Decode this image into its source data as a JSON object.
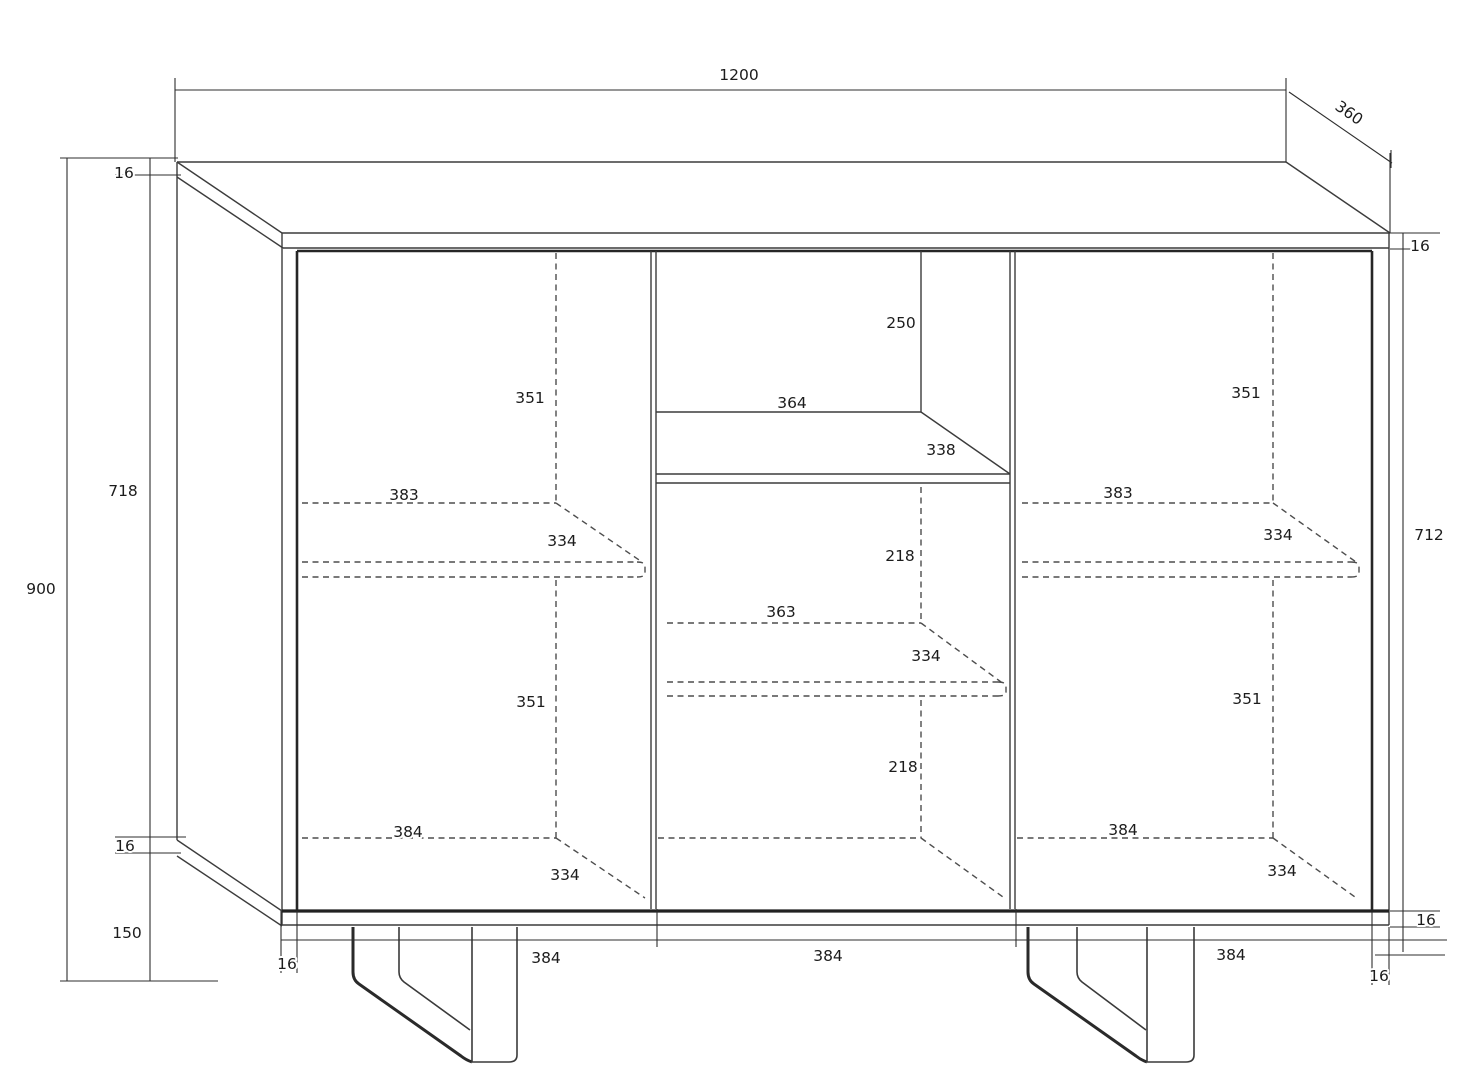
{
  "drawing": {
    "kind": "furniture-technical-drawing",
    "subject": "three-door sideboard with open niche, shelves and angled legs"
  },
  "colors": {
    "background": "#ffffff",
    "line": "#3c3c3c",
    "line_dark": "#262626",
    "dashed_line": "#4d4d4d",
    "text": "#1c1c1c"
  },
  "dimensions": {
    "top": {
      "width": "1200",
      "depth": "360"
    },
    "left": {
      "top_panel_thickness": "16",
      "interior_height": "718",
      "total_height": "900",
      "bottom_panel_thickness": "16",
      "leg_height": "150"
    },
    "right": {
      "top_panel_thickness": "16",
      "front_opening_height": "712",
      "bottom_panel_thickness": "16"
    },
    "bottom": {
      "left_side_thickness": "16",
      "door1_width": "384",
      "door2_width": "384",
      "door3_width": "384",
      "right_side_thickness": "16"
    },
    "left_door": {
      "upper_section_height": "351",
      "shelf_width": "383",
      "shelf_depth": "334",
      "lower_section_height": "351",
      "bottom_width": "384",
      "bottom_depth": "334"
    },
    "middle_niche": {
      "height": "250",
      "width": "364",
      "depth": "338"
    },
    "middle_door": {
      "upper_section_height": "218",
      "shelf_width": "363",
      "shelf_depth": "334",
      "lower_section_height": "218"
    },
    "right_door": {
      "upper_section_height": "351",
      "shelf_width": "383",
      "shelf_depth": "334",
      "lower_section_height": "351",
      "bottom_width": "384",
      "bottom_depth": "334"
    }
  }
}
